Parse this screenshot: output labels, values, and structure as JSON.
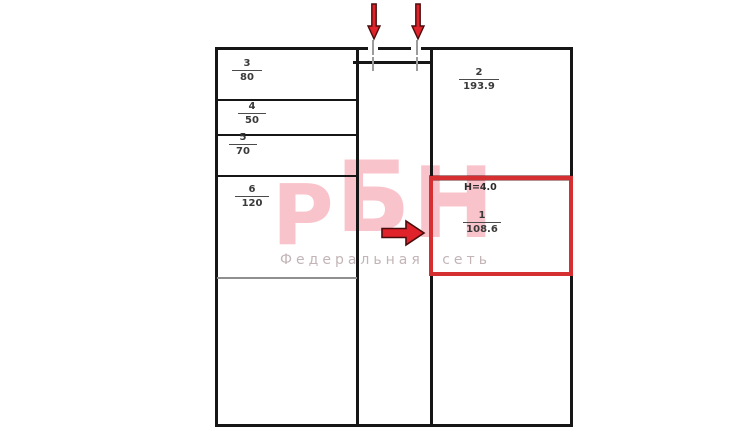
{
  "watermark": {
    "logo_letter_1": "Р",
    "logo_letter_2": "Б",
    "logo_letter_3": "Н",
    "tagline_word_1": "Федеральная",
    "tagline_word_2": "сеть"
  },
  "plan": {
    "rooms": [
      {
        "number": "1",
        "area": "108.6",
        "height_note": "H=4.0",
        "highlighted": true
      },
      {
        "number": "2",
        "area": "193.9",
        "highlighted": false
      },
      {
        "number": "3",
        "area": "80",
        "highlighted": false
      },
      {
        "number": "4",
        "area": "50",
        "highlighted": false
      },
      {
        "number": "5",
        "area": "70",
        "highlighted": false
      },
      {
        "number": "6",
        "area": "120",
        "highlighted": false
      }
    ],
    "icons": [
      "entrance-arrow-down-icon",
      "entrance-arrow-down-icon",
      "selection-arrow-right-icon"
    ],
    "colors": {
      "highlight_red": "#d62f31",
      "arrow_red": "#e0222a",
      "arrow_outline": "#4a0c0c",
      "wall_black": "#161616",
      "secondary_wall_gray": "#8f8f8f",
      "door_tick_gray": "#9c9c9c",
      "watermark_pink": "#f8c3cb",
      "tagline_gray": "#c3b5b7"
    }
  }
}
